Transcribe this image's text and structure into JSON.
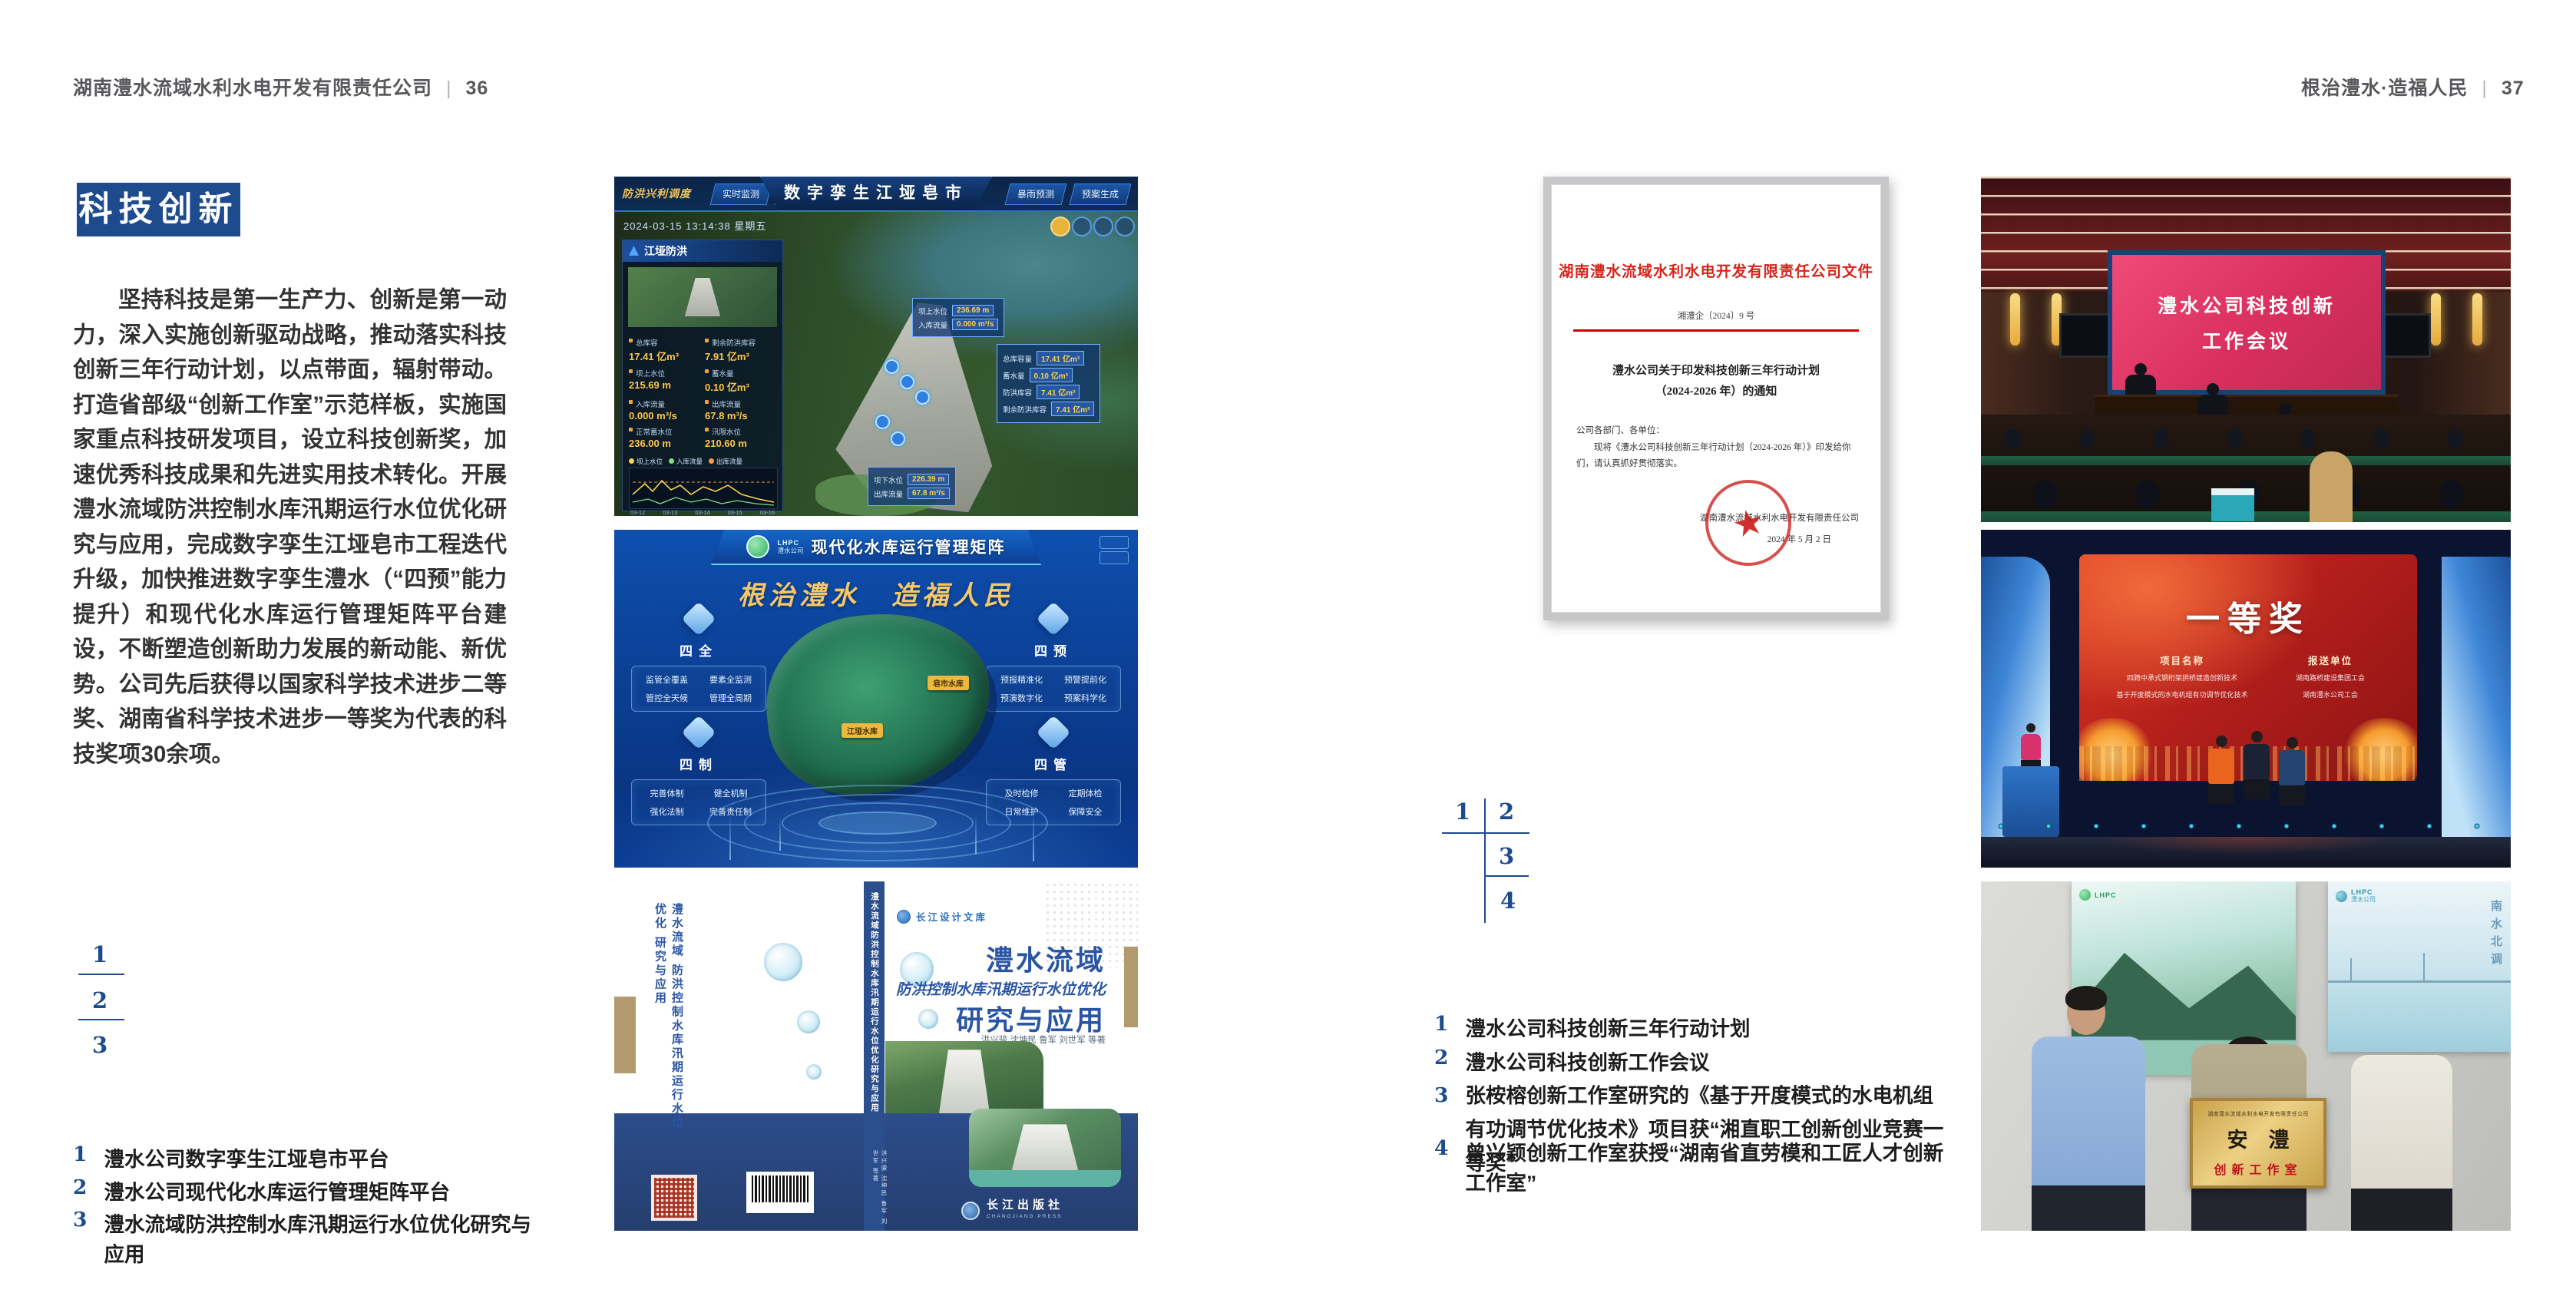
{
  "accent": {
    "blue": "#1e4b8d",
    "red": "#cf2318",
    "gold": "#e9b93d"
  },
  "left_page": {
    "header": {
      "company": "湖南澧水流域水利水电开发有限责任公司",
      "divider": "|",
      "page_no": "36"
    },
    "badge": "科技创新",
    "paragraph": "坚持科技是第一生产力、创新是第一动力，深入实施创新驱动战略，推动落实科技创新三年行动计划，以点带面，辐射带动。打造省部级“创新工作室”示范样板，实施国家重点科技研发项目，设立科技创新奖，加速优秀科技成果和先进实用技术转化。开展澧水流域防洪控制水库汛期运行水位优化研究与应用，完成数字孪生江垭皂市工程迭代升级，加快推进数字孪生澧水（“四预”能力提升）和现代化水库运行管理矩阵平台建设，不断塑造创新助力发展的新动能、新优势。公司先后获得以国家科学技术进步二等奖、湖南省科学技术进步一等奖为代表的科技奖项30余项。",
    "figure_index": {
      "n1": "1",
      "n2": "2",
      "n3": "3"
    },
    "captions": [
      {
        "no": "1",
        "text": "澧水公司数字孪生江垭皂市平台"
      },
      {
        "no": "2",
        "text": "澧水公司现代化水库运行管理矩阵平台"
      },
      {
        "no": "3",
        "text": "澧水流域防洪控制水库汛期运行水位优化研究与应用"
      }
    ]
  },
  "right_page": {
    "header": {
      "motto": "根治澧水·造福人民",
      "divider": "|",
      "page_no": "37"
    },
    "figure_index": {
      "n1": "1",
      "n2": "2",
      "n3": "3",
      "n4": "4"
    },
    "captions": [
      {
        "no": "1",
        "text": "澧水公司科技创新三年行动计划"
      },
      {
        "no": "2",
        "text": "澧水公司科技创新工作会议"
      },
      {
        "no": "3",
        "text": "张桉榕创新工作室研究的《基于开度模式的水电机组有功调节优化技术》项目获“湘直职工创新创业竞赛一等奖”"
      },
      {
        "no": "4",
        "text": "曾兴颖创新工作室获授“湖南省直劳模和工匠人才创新工作室”"
      }
    ]
  },
  "dashboard": {
    "nav_label": "防洪兴利调度",
    "tabs_left": [
      "实时监测",
      "洪水预报",
      "防汛预警"
    ],
    "title": "数字孪生江垭皂市",
    "tabs_right": [
      "暴雨预测",
      "预案生成",
      "调度执行",
      "工程导览"
    ],
    "datetime": "2024-03-15 13:14:38 星期五",
    "panel1_title": "江垭防洪",
    "p1": [
      {
        "l": "总库容",
        "v": "17.41 亿m³"
      },
      {
        "l": "剩余防洪库容",
        "v": "7.91 亿m³"
      },
      {
        "l": "坝上水位",
        "v": "215.69 m"
      },
      {
        "l": "蓄水量",
        "v": "0.10 亿m³"
      },
      {
        "l": "入库流量",
        "v": "0.000 m³/s"
      },
      {
        "l": "出库流量",
        "v": "67.8 m³/s"
      },
      {
        "l": "正常蓄水位",
        "v": "236.00 m"
      },
      {
        "l": "汛限水位",
        "v": "210.60 m"
      }
    ],
    "legend": [
      "坝上水位",
      "入库流量",
      "出库流量"
    ],
    "x_axis": [
      "03-12",
      "03-13",
      "03-14",
      "03-15",
      "03-16"
    ],
    "panel2_title": "江垭发电",
    "p2": [
      {
        "l": "年发电计划",
        "v": "6.3000 亿kWh"
      },
      {
        "l": "年累计发电量",
        "v": "1.2907 亿kWh"
      },
      {
        "l": "月累计发电量",
        "v": "3359.21 万"
      },
      {
        "l": "当前出力",
        "v": "(MW)"
      },
      {
        "l": "发电流量",
        "v": "0.00 m³/s"
      },
      {
        "l": "弃水流量",
        "v": "0.00 m³/s"
      }
    ],
    "callout1": [
      {
        "l": "坝上水位",
        "v": "236.69 m"
      },
      {
        "l": "入库流量",
        "v": "0.000 m³/s"
      }
    ],
    "callout2": [
      {
        "l": "总库容量",
        "v": "17.41 亿m³"
      },
      {
        "l": "蓄水量",
        "v": "0.10 亿m³"
      },
      {
        "l": "防洪库容",
        "v": "7.41 亿m³"
      },
      {
        "l": "剩余防洪库容",
        "v": "7.41 亿m³"
      }
    ],
    "callout3": [
      {
        "l": "坝下水位",
        "v": "226.39 m"
      },
      {
        "l": "出库流量",
        "v": "67.8 m³/s"
      }
    ]
  },
  "matrix": {
    "logo_line1": "LHPC",
    "logo_line2": "澧水公司",
    "title": "现代化水库运行管理矩阵",
    "slogan": "根治澧水　造福人民",
    "groups": [
      {
        "name": "四全",
        "items": [
          "监管全覆盖",
          "要素全监测",
          "管控全天候",
          "管理全周期"
        ]
      },
      {
        "name": "四预",
        "items": [
          "预报精准化",
          "预警提前化",
          "预演数字化",
          "预案科学化"
        ]
      },
      {
        "name": "四制",
        "items": [
          "完善体制",
          "健全机制",
          "强化法制",
          "完善责任制"
        ]
      },
      {
        "name": "四管",
        "items": [
          "及时检修",
          "定期体检",
          "日常维护",
          "保障安全"
        ]
      }
    ],
    "map_tags": [
      "江垭水库",
      "皂市水库"
    ]
  },
  "book": {
    "series": "长江设计文库",
    "title_main": "澧水流域",
    "title_sub": "防洪控制水库汛期运行水位优化",
    "title_tail": "研究与应用",
    "authors": "洪兴骏 沈坤民 鲁军 刘世军 等著",
    "spine_title": "澧水流域防洪控制水库汛期运行水位优化研究与应用",
    "spine_authors": "洪兴骏 沈坤民 鲁军 刘世军 等著",
    "publisher": "长江出版社",
    "publisher_en": "CHANGJIANG PRESS"
  },
  "document": {
    "title": "湖南澧水流域水利水电开发有限责任公司文件",
    "doc_no": "湘澧企〔2024〕9 号",
    "subject_line1": "澧水公司关于印发科技创新三年行动计划",
    "subject_line2": "（2024-2026 年）的通知",
    "salutation": "公司各部门、各单位：",
    "body": "现将《澧水公司科技创新三年行动计划（2024-2026 年）》印发给你们，请认真抓好贯彻落实。",
    "signer": "湖南澧水流域水利水电开发有限责任公司",
    "date": "2024 年 5 月 2 日"
  },
  "meeting": {
    "screen_line1": "澧水公司科技创新",
    "screen_line2": "工作会议"
  },
  "award": {
    "title": "一等奖",
    "col1_header": "项目名称",
    "col2_header": "报送单位",
    "projects": [
      "四跨中承式钢桁架拱桥建造创新技术",
      "基于开度模式的水电机组有功调节优化技术"
    ],
    "units": [
      "湖南路桥建设集团工会",
      "湖南澧水公司工会"
    ]
  },
  "workshop": {
    "poster_logo_abbr": "LHPC",
    "poster_logo_name": "澧水公司",
    "poster2_vtext": "南水北调",
    "plaque_top": "湖南澧水流域水利水电开发有限责任公司",
    "plaque_main": "安　澧",
    "plaque_sub": "创新工作室"
  }
}
